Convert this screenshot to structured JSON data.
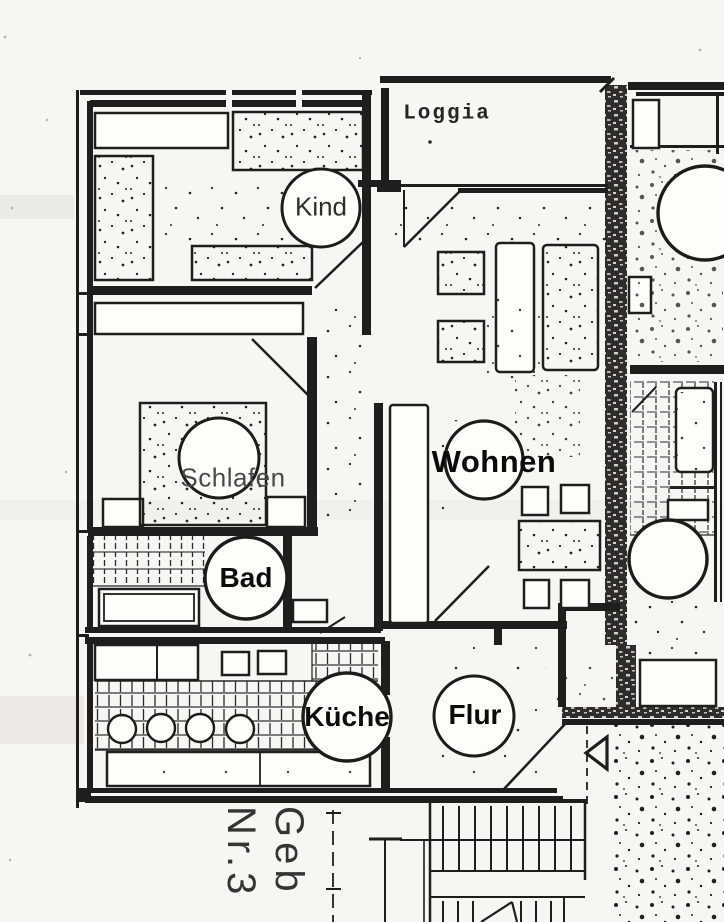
{
  "floor_plan": {
    "rooms": [
      {
        "id": "kind",
        "label": "Kind"
      },
      {
        "id": "loggia",
        "label": "Loggia"
      },
      {
        "id": "wohnen",
        "label": "Wohnen"
      },
      {
        "id": "schlafen",
        "label": "Schlafen"
      },
      {
        "id": "bad",
        "label": "Bad"
      },
      {
        "id": "kueche",
        "label": "Küche"
      },
      {
        "id": "flur",
        "label": "Flur"
      }
    ],
    "building_label": {
      "line1": "Geb",
      "line2": "Nr.3"
    },
    "colors": {
      "ink": "#1e1e1e",
      "paper": "#f7f6f2",
      "wall_hatch": "#2e2d2b"
    }
  }
}
